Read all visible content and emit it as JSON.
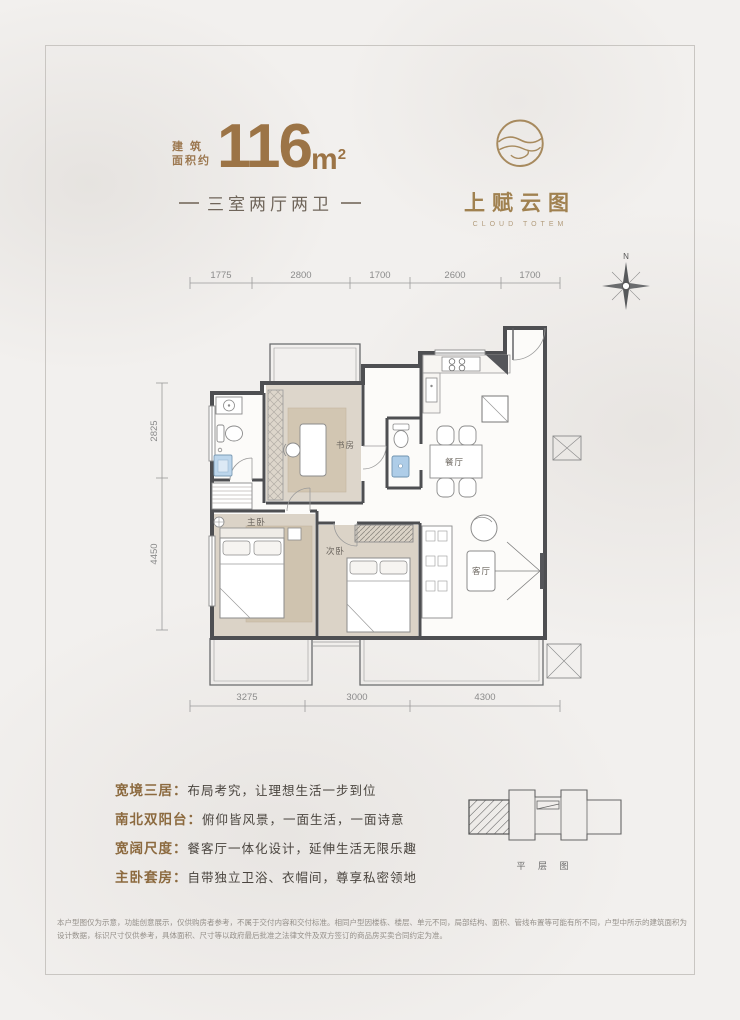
{
  "header": {
    "area_label_1": "建 筑",
    "area_label_2": "面积约",
    "area_value": "116",
    "area_unit": "m",
    "area_exponent": "2",
    "subtitle": "三室两厅两卫"
  },
  "logo": {
    "cn": "上赋云图",
    "en": "CLOUD TOTEM"
  },
  "compass": {
    "north": "N"
  },
  "plan": {
    "dims_top": [
      "1775",
      "2800",
      "1700",
      "2600",
      "1700"
    ],
    "dims_left": [
      "2825",
      "4450"
    ],
    "dims_bottom": [
      "3275",
      "3000",
      "4300"
    ],
    "rooms": {
      "study": "书房",
      "dining": "餐厅",
      "master": "主卧",
      "second": "次卧",
      "living": "客厅"
    }
  },
  "features": [
    {
      "label": "宽境三居：",
      "desc": "布局考究，让理想生活一步到位"
    },
    {
      "label": "南北双阳台：",
      "desc": "俯仰皆风景，一面生活，一面诗意"
    },
    {
      "label": "宽阔尺度：",
      "desc": "餐客厅一体化设计，延伸生活无限乐趣"
    },
    {
      "label": "主卧套房：",
      "desc": "自带独立卫浴、衣帽间，尊享私密领地"
    }
  ],
  "keyplan": {
    "caption": "平 层 图"
  },
  "disclaimer": "本户型图仅为示意，功能创意展示，仅供购房者参考，不属于交付内容和交付标准。相同户型因楼栋、楼层、单元不同，局部结构、面积、管线布置等可能有所不同，户型中所示的建筑面积为设计数据，标识尺寸仅供参考，具体面积、尺寸等以政府最后批准之法律文件及双方签订的商品房买卖合同约定为准。",
  "colors": {
    "accent": "#9c7446",
    "wall": "#4e4f52",
    "feature_label": "#8c6a3f"
  }
}
